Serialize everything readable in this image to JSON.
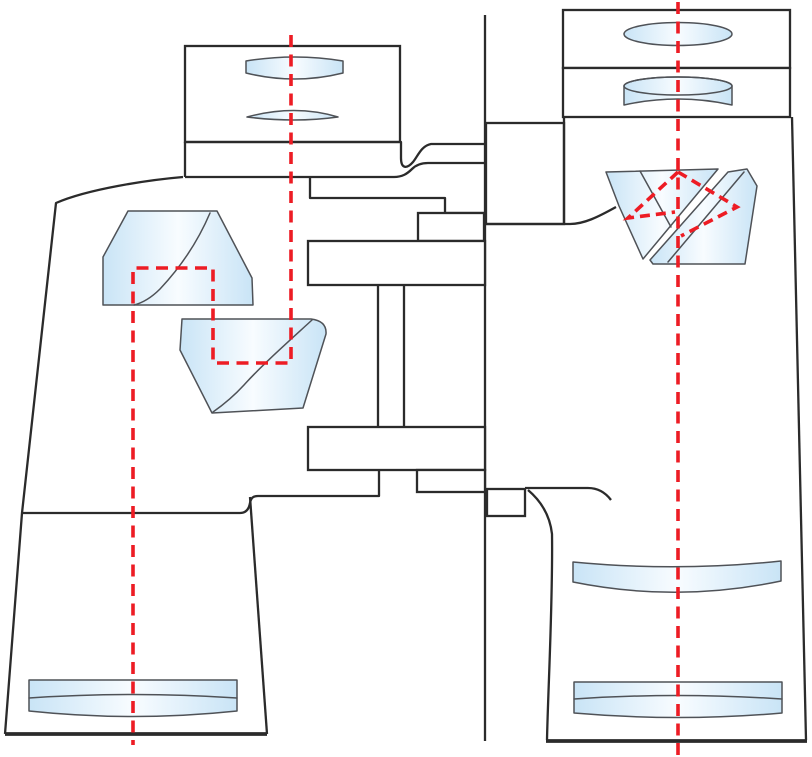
{
  "diagram": {
    "kind": "binoculars-optical-cutaway",
    "description": "Cutaway technical illustration of porro-prism binoculars showing internal optical elements and red dashed light paths",
    "text_labels": []
  },
  "colors": {
    "background": "#ffffff",
    "stroke_main": "#2b2b2b",
    "stroke_glass": "#4f5257",
    "glass_edge": "#c9e4f6",
    "glass_mid": "#f8fcff",
    "ray_red": "#ed1c24"
  },
  "parts": {
    "left_barrel": [
      "eyepiece-housing",
      "eye-lens",
      "field-lens",
      "eyepiece-collar",
      "barrel-body",
      "porro-prism-upper",
      "porro-prism-lower",
      "objective-doublet",
      "light-path"
    ],
    "center_bridge": [
      "hinge-axis",
      "bridge-step",
      "bridge-plate-upper",
      "hinge-columns",
      "bridge-plate-lower",
      "axle-housing",
      "axle-box"
    ],
    "right_barrel": [
      "eyepiece-housing-top",
      "eyepiece-housing-mid",
      "eye-lens",
      "field-lens",
      "barrel-body",
      "porro-prism-left",
      "porro-prism-right",
      "field-flattener-lens",
      "objective-doublet",
      "optical-axis",
      "prism-light-path"
    ]
  }
}
